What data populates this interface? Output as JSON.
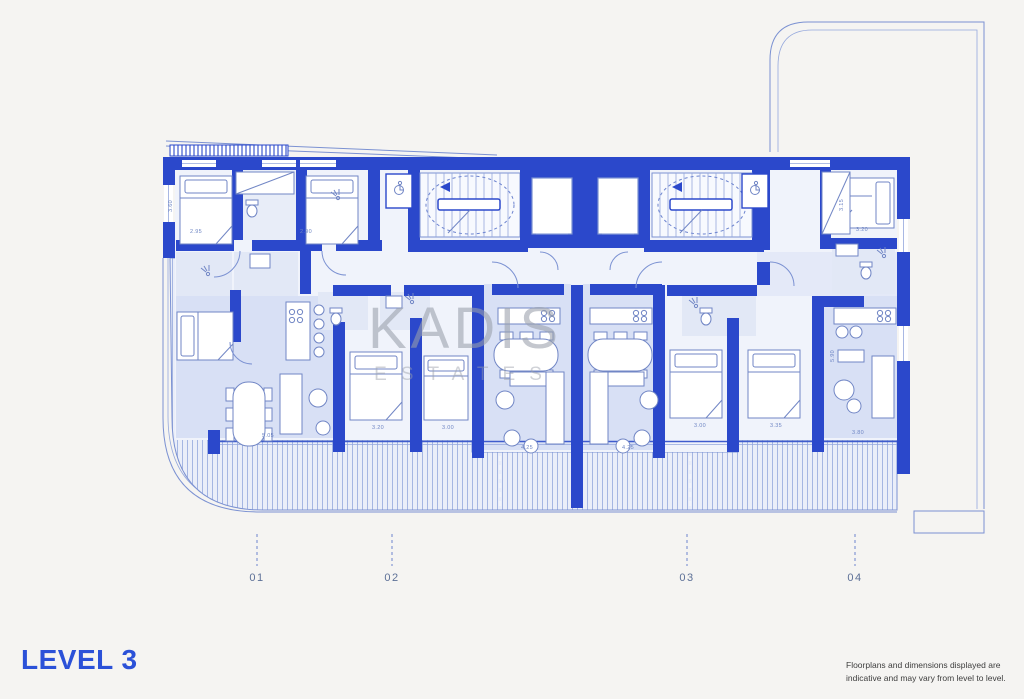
{
  "page": {
    "background": "#f5f4f2"
  },
  "watermark": {
    "line1": "KADIS",
    "line2": "ESTATES"
  },
  "plan": {
    "grid_markers": [
      {
        "label": "01"
      },
      {
        "label": "02"
      },
      {
        "label": "03"
      },
      {
        "label": "04"
      }
    ],
    "dimensions": [
      {
        "v": "2.95"
      },
      {
        "v": "2.90"
      },
      {
        "v": "3.20"
      },
      {
        "v": "3.60"
      },
      {
        "v": "3.15"
      },
      {
        "v": "5.05"
      },
      {
        "v": "3.20"
      },
      {
        "v": "3.00"
      },
      {
        "v": "4.25"
      },
      {
        "v": "4.25"
      },
      {
        "v": "3.00"
      },
      {
        "v": "3.35"
      },
      {
        "v": "3.80"
      },
      {
        "v": "5.90"
      }
    ],
    "colors": {
      "wall": "#2b48cb",
      "room_fill": "#f0f3fb",
      "living_fill": "#d8e0f5",
      "bath_fill": "#e2e8f6",
      "balcony_hatch": "#9db0e0",
      "outline": "#7b91d2",
      "watermark": "#9aa0ab",
      "accent_text": "#2b51d8",
      "grid_text": "#5d7097"
    }
  },
  "footer": {
    "level_label": "LEVEL 3",
    "disclaimer_line1": "Floorplans and dimensions displayed are",
    "disclaimer_line2": "indicative and may vary from level to level."
  }
}
